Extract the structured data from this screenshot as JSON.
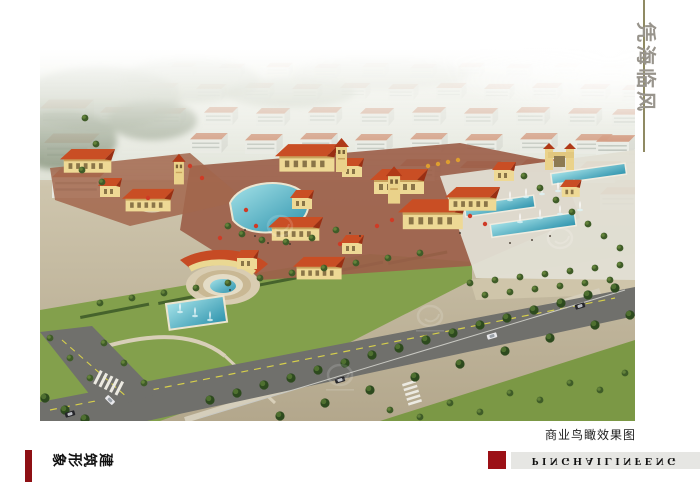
{
  "title": {
    "text": "凭海临风",
    "color": "#98948c"
  },
  "divider": {
    "color": "#8f8a63"
  },
  "rendering": {
    "caption": "商业鸟瞰效果图"
  },
  "footer": {
    "left_label": "建筑形象",
    "brand_text": "PINGHAILINFENG",
    "accent_color": "#9c1016",
    "left_accent_color": "#8e1014",
    "bar_color": "#e6e6e3"
  }
}
